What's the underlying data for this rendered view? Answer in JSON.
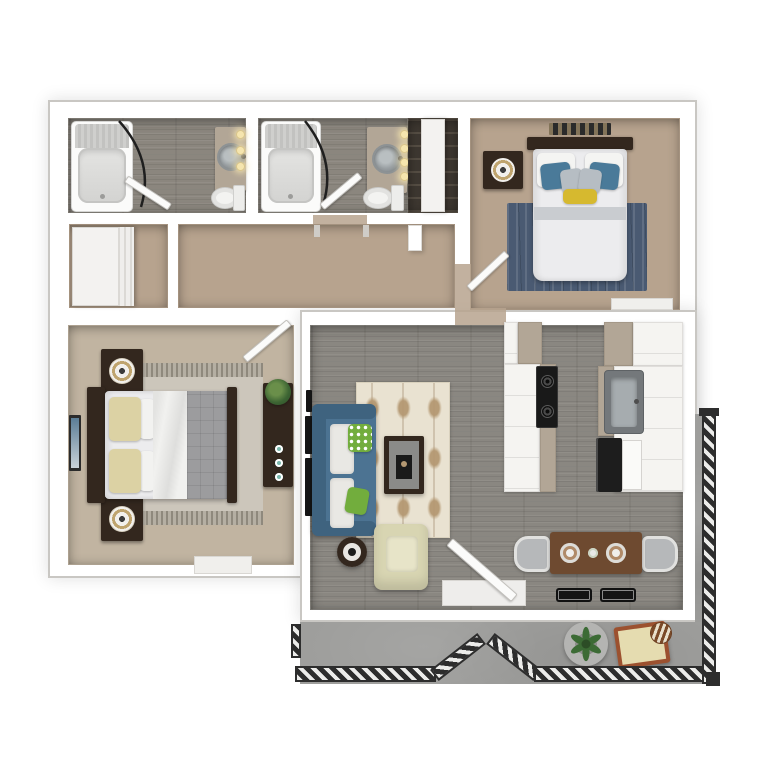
{
  "title": "3d-apartment-floor-plan",
  "palette": {
    "wall_edge": "#c9c7c3",
    "carpet_tan": "#b7a38e",
    "carpet_light": "#c1b4a1",
    "wood_bath": "#8b867e",
    "wood_living": "#8a8781",
    "concrete": "#9e9e9c",
    "taupe": "#b2a696",
    "cab_white": "#f5f4f1",
    "stove_black": "#191919",
    "appliance_black": "#1d1d1d",
    "furn_dark": "#33271e",
    "table_top_gray": "#8b8b89",
    "dining_table": "#6e4a30",
    "sofa": "#4c7392",
    "sofa_dark": "#3f637f",
    "pillow_green": "#72ad3d",
    "rug_cream": "#e9e2d1",
    "rug_navy": "#4a5a72",
    "rug_master": "#ccc6bb",
    "bed_white": "#ececee",
    "blanket_fold": "#c9ccd0",
    "pillow_blue": "#4a7a99",
    "pillow_gray": "#b6bdc3",
    "pillow_yellow": "#d6b92f",
    "pillow_cream": "#dcd2a4",
    "duvet_gray": "#9c9c9e",
    "sheet_white": "#f1f1ef",
    "lamp_gold": "#bfa46e",
    "door_white": "#fbfbfa",
    "door_edge": "#c2c0bc",
    "rail_dark": "#2d2d2d",
    "rail_slat": "#ececea",
    "patio_chair": "#9c512f",
    "patio_cushion": "#e5dcb0",
    "plant_green": "#3c6b35",
    "bulb": "#f5e5ae",
    "closet_dark": "#3e3831",
    "closet_shelf": "#564e44",
    "panel_white": "#f3f2f0",
    "teal_dot": "#7ab7ad",
    "mat_black": "#141414",
    "mat_white": "#eeedeb",
    "armchair": "#d8d5b2",
    "armchair_cushion": "#e7e4c8",
    "sill": "#f0efec"
  },
  "floorplan": {
    "rooms": [
      {
        "name": "bathroom-1",
        "floor": "wood"
      },
      {
        "name": "bathroom-2",
        "floor": "wood"
      },
      {
        "name": "linen-closet",
        "floor": "dark-shelving"
      },
      {
        "name": "bedroom-2",
        "floor": "carpet"
      },
      {
        "name": "hall-closet",
        "floor": "carpet"
      },
      {
        "name": "hallway",
        "floor": "carpet"
      },
      {
        "name": "master-bedroom",
        "floor": "carpet"
      },
      {
        "name": "living-room",
        "floor": "wood-plank"
      },
      {
        "name": "kitchen",
        "floor": "wood-plank"
      },
      {
        "name": "dining-nook",
        "floor": "wood-plank"
      },
      {
        "name": "balcony",
        "floor": "concrete"
      }
    ],
    "furniture": {
      "bathroom_1": [
        "bathtub",
        "shower-curtain",
        "vanity-sink",
        "mirror-lights-3",
        "toilet",
        "door"
      ],
      "bathroom_2": [
        "bathtub",
        "shower-curtain",
        "vanity-sink",
        "mirror-lights-4",
        "toilet",
        "door"
      ],
      "linen_closet": [
        "sliding-panel",
        "shelving"
      ],
      "bedroom_2": [
        "wall-art",
        "headboard",
        "bed",
        "white-pillows",
        "blue-pillows",
        "gray-pillows",
        "yellow-pillow",
        "navy-rug",
        "nightstand",
        "table-lamp",
        "door"
      ],
      "hall_closet": [
        "sliding-panel"
      ],
      "master_bedroom": [
        "headboard",
        "bed",
        "cream-pillows",
        "white-sheet",
        "gray-duvet",
        "foot-rail",
        "area-rug",
        "nightstand-top",
        "nightstand-bottom",
        "table-lamps",
        "wall-art",
        "dresser",
        "plant",
        "decor-bowls",
        "window-sill",
        "door"
      ],
      "living_room": [
        "wall-tv",
        "blue-sofa",
        "white-cushions",
        "green-pillows",
        "patterned-rug",
        "coffee-table",
        "armchair",
        "round-side-table",
        "entry-door",
        "entry-mat"
      ],
      "kitchen": [
        "upper-cabinets",
        "peninsula-counter",
        "cooktop",
        "wall-counter",
        "sink",
        "oven",
        "dishwasher"
      ],
      "dining_nook": [
        "table",
        "two-chairs",
        "two-place-settings",
        "centerpiece",
        "two-black-mats"
      ],
      "balcony": [
        "railing",
        "railing-gap",
        "potted-plant",
        "patio-chair",
        "striped-cushion"
      ]
    }
  }
}
